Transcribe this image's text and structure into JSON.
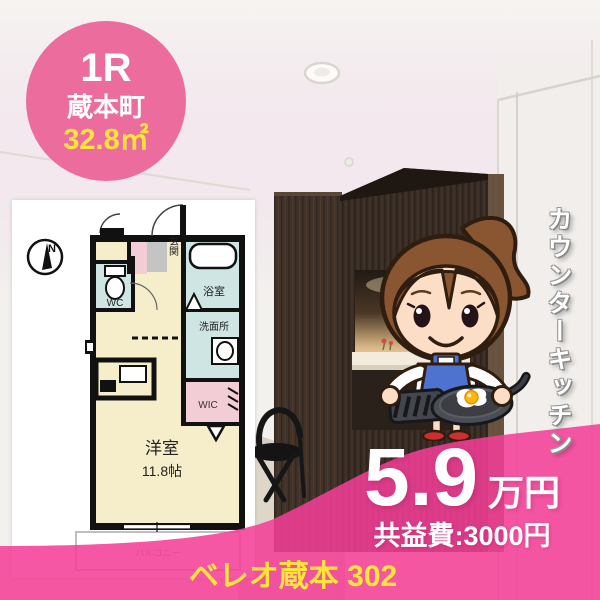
{
  "badge": {
    "layout_type": "1R",
    "district": "蔵本町",
    "area": "32.8㎡"
  },
  "floorplan": {
    "compass": "N",
    "labels": {
      "entrance": "玄関",
      "toilet": "WC",
      "bath": "浴室",
      "washroom": "洗面所",
      "closet": "WIC",
      "main_room": "洋室",
      "main_room_size": "11.8帖",
      "balcony": "バルコニー"
    }
  },
  "photo_caption": "カウンターキッチン",
  "price": {
    "rent": "5.9",
    "unit": "万円",
    "common_fee": "共益費:3000円"
  },
  "footer": {
    "property": "ベレオ蔵本 302"
  },
  "colors": {
    "overlay_pink": "#f23e97",
    "badge_pink": "#eb6c9d",
    "highlight_yellow": "#ffe53a",
    "cabinet_brown": "#392d25",
    "room_cream": "#f6eecb",
    "room_blue": "#cfe5e3",
    "room_pink": "#f3cdd5"
  }
}
